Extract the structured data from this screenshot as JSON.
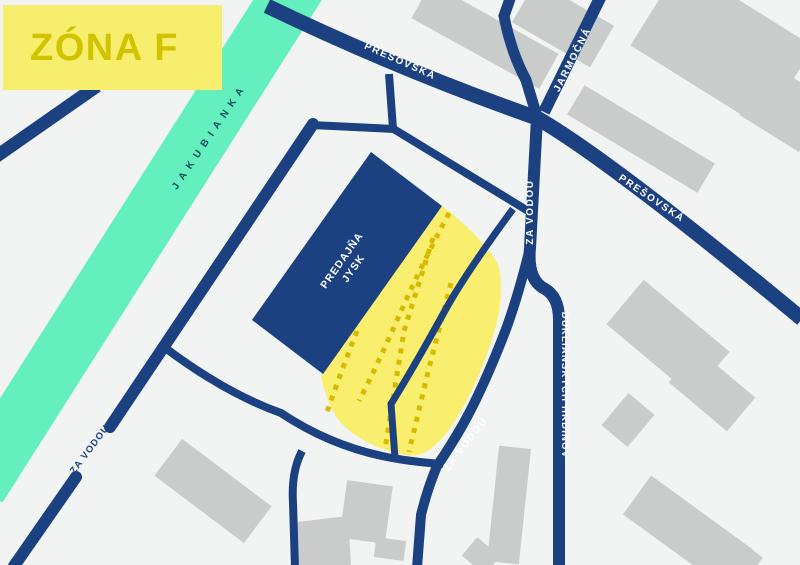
{
  "banner": {
    "label": "ZÓNA F"
  },
  "labels": {
    "river": "JAKUBIANKA",
    "presovska_left": "PREŠOVSKÁ",
    "presovska_right": "PREŠOVSKÁ",
    "jarmocna": "JARMOČNÁ",
    "zavodou_vertical": "ZA VODOU",
    "zavodou_diagonal": "ZA VODOU",
    "zavodou_gap": "ZA VODOU",
    "dukliansky": "DUKLIANSKYCH HRDINOV",
    "store_line1": "PREDAJŇA",
    "store_line2": "JYSK"
  },
  "colors": {
    "background": "#f2f4f3",
    "road_navy": "#1b4181",
    "zone_yellow": "#f9ee6d",
    "stall_dots": "#d5ba00",
    "river_mint": "#63efbe",
    "building_gray": "#cacccb",
    "banner_fill": "#f7ee6e",
    "banner_text": "#d2c300",
    "river_text": "#114e60"
  },
  "legend": {
    "zone_name": "ZÓNA F",
    "zone_type": "parking-zone-map"
  }
}
